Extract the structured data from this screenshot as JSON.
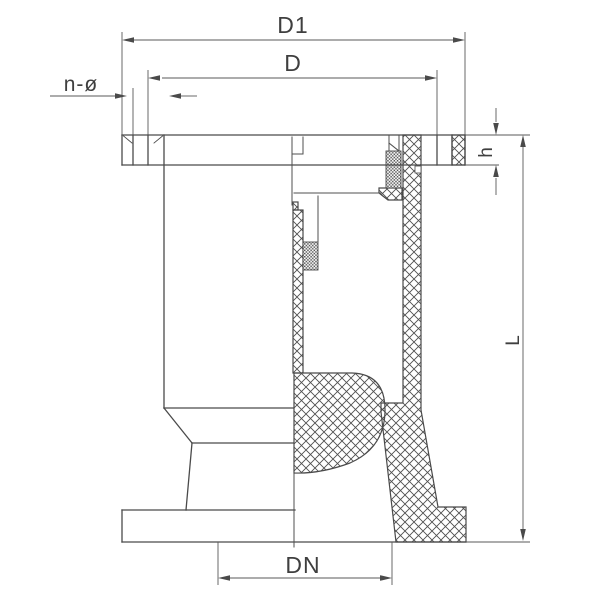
{
  "drawing": {
    "type": "engineering-section-drawing",
    "subject": "flanged valve cross-section",
    "labels": {
      "d1": "D1",
      "d": "D",
      "n_phi": "n-ø",
      "h": "h",
      "l": "L",
      "dn": "DN"
    },
    "colors": {
      "background": "#ffffff",
      "outline": "#4a4a4a",
      "dimension": "#555555",
      "hatch": "#4f4f4f",
      "text": "#3f3f3f"
    }
  }
}
